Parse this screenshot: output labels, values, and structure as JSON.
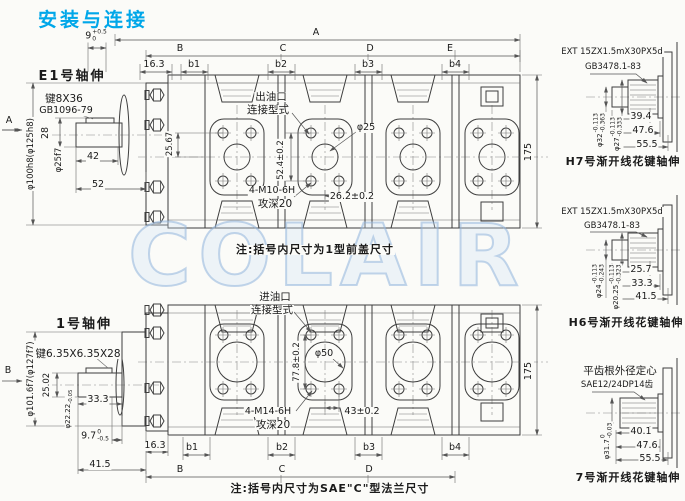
{
  "title": "安装与连接",
  "watermark": "COLAIR",
  "colors": {
    "title": "#00a7e9",
    "line": "#3e3e3e",
    "watermark": "#a8c8e8"
  },
  "upper": {
    "view_label": "E1号轴伸",
    "view_arrow": "A",
    "key_line1": "键8X36",
    "key_line2": "GB1096-79",
    "flange_dia": "φ100h8(φ125h8)",
    "shaft_dia": "φ25f7",
    "dim_key_width": "28",
    "dim_key_len": "42",
    "dim_shaft_len": "52",
    "dim_pilot": "9",
    "dim_pilot_tol_up": "+0.5",
    "dim_pilot_tol_dn": "0",
    "dim_overall": "A",
    "sec_b": "B",
    "sec_c": "C",
    "sec_d": "D",
    "sec_e": "E",
    "dim_163": "16.3",
    "b1": "b1",
    "b2": "b2",
    "b3": "b3",
    "b4": "b4",
    "dim_2567": "25.67",
    "dim_height": "175",
    "port_label1": "出油口",
    "port_label2": "连接型式",
    "port_dia": "φ25",
    "dim_bolt_v": "52.4±0.2",
    "thread_spec": "4-M10-6H",
    "thread_depth": "攻深20",
    "dim_bolt_h": "26.2±0.2",
    "note": "注:括号内尺寸为1型前盖尺寸"
  },
  "lower": {
    "view_label": "1号轴伸",
    "view_arrow": "B",
    "key_line1": "键6.35X6.35X28",
    "flange_dia": "φ101.6f7(φ127f7)",
    "dim_key_width": "25.02",
    "shaft_dia": "φ22.22",
    "shaft_dia_tol": "-0.05",
    "dim_shaft_len": "33.3",
    "dim_step": "9.7",
    "dim_step_tol_up": "0",
    "dim_step_tol_dn": "-0.5",
    "dim_163": "16.3",
    "dim_415": "41.5",
    "b1": "b1",
    "b2": "b2",
    "b3": "b3",
    "b4": "b4",
    "sec_b": "B",
    "sec_c": "C",
    "sec_d": "D",
    "dim_height": "175",
    "port_label1": "进油口",
    "port_label2": "连接型式",
    "port_dia": "φ50",
    "dim_bolt_v": "77.8±0.2",
    "thread_spec": "4-M14-6H",
    "thread_depth": "攻深20",
    "dim_bolt_h": "43±0.2",
    "note": "注:括号内尺寸为SAE\"C\"型法兰尺寸"
  },
  "splines": [
    {
      "spec1": "EXT 15ZX1.5mX30PX5d",
      "spec2": "GB3478.1-83",
      "dia1": "φ32",
      "dia1_up": "-0.113",
      "dia1_dn": "-0.363",
      "dia2": "φ27",
      "dia2_up": "-0.113",
      "dia2_dn": "-0.333",
      "dim1": "39.4",
      "dim2": "47.6",
      "dim3": "55.5",
      "caption": "H7号渐开线花键轴伸"
    },
    {
      "spec1": "EXT 15ZX1.5mX30PX5d",
      "spec2": "GB3478.1-83",
      "dia1": "φ24",
      "dia1_up": "-0.113",
      "dia1_dn": "-0.243",
      "dia2": "φ20.25",
      "dia2_up": "-0.113",
      "dia2_dn": "-0.323",
      "dim1": "25.7",
      "dim2": "33.3",
      "dim3": "41.5",
      "caption": "H6号渐开线花键轴伸"
    },
    {
      "spec1": "平齿根外径定心",
      "spec2": "SAE12/24DP14齿",
      "dia1": "φ31.7",
      "dia1_up": "0",
      "dia1_dn": "-0.03",
      "dim1": "40.1",
      "dim2": "47.6",
      "dim3": "55.5",
      "caption": "7号渐开线花键轴伸"
    }
  ]
}
